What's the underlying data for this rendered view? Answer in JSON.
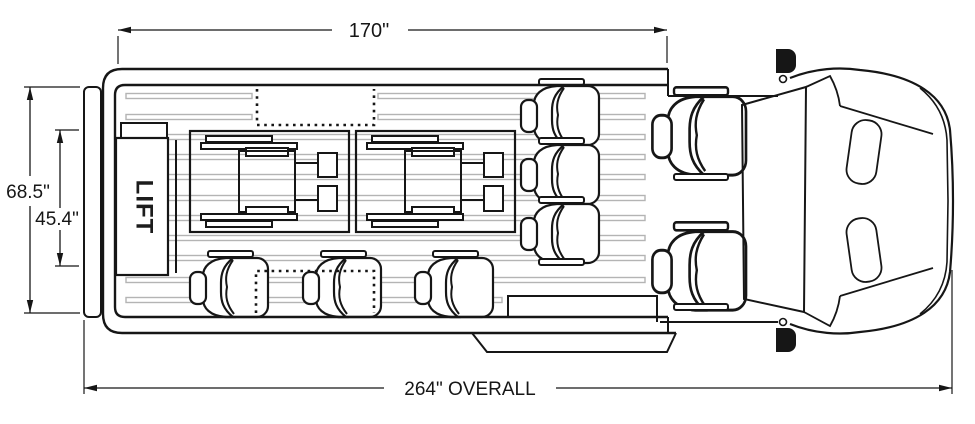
{
  "labels": {
    "top_length": "170\"",
    "exterior_width": "68.5\"",
    "interior_width": "45.4\"",
    "overall_length": "264\" OVERALL",
    "lift": "LIFT"
  },
  "colors": {
    "line": "#161616",
    "floor_track": "#b4b4b4",
    "background": "#ffffff",
    "mirror_fill": "#161616"
  }
}
